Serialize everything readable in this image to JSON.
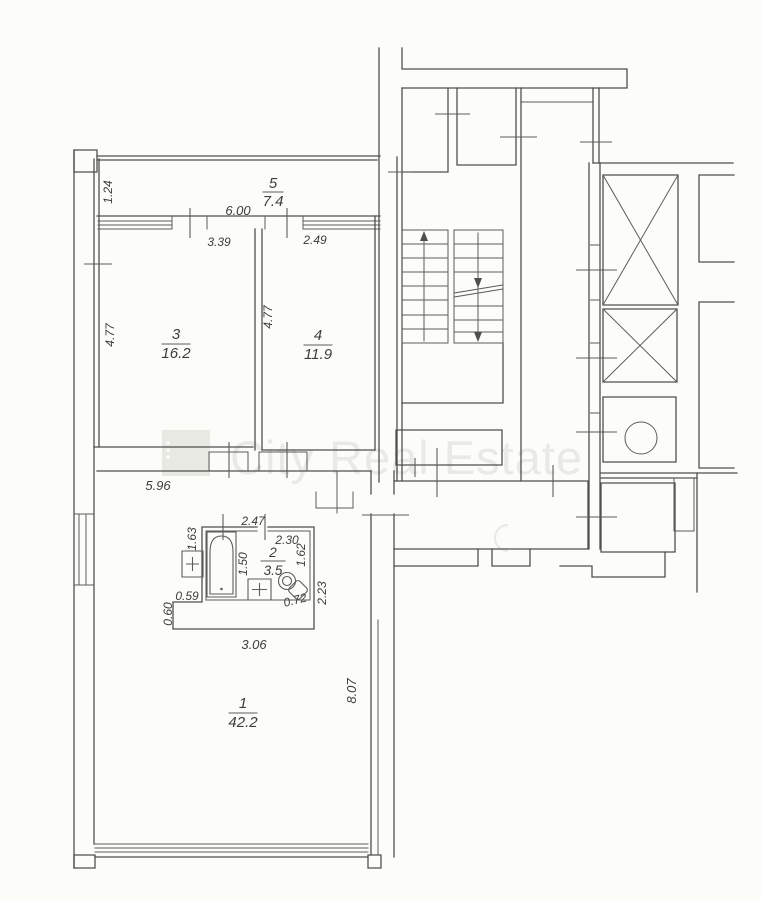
{
  "document_type": "apartment-floor-plan-scan",
  "watermark": {
    "text": "City Real Estate"
  },
  "rooms": {
    "r1": {
      "number": "1",
      "area": "42.2"
    },
    "r2": {
      "number": "2",
      "area": "3.5"
    },
    "r3": {
      "number": "3",
      "area": "16.2"
    },
    "r4": {
      "number": "4",
      "area": "11.9"
    },
    "r5": {
      "number": "5",
      "area": "7.4"
    }
  },
  "dims": {
    "d124": "1.24",
    "d600": "6.00",
    "d339": "3.39",
    "d249": "2.49",
    "d477a": "4.77",
    "d477b": "4.77",
    "d596": "5.96",
    "d247": "2.47",
    "d230": "2.30",
    "d163": "1.63",
    "d150": "1.50",
    "d162": "1.62",
    "d059": "0.59",
    "d060": "0.60",
    "d306": "3.06",
    "d072": "0.72",
    "d223": "2.23",
    "d807": "8.07"
  },
  "colors": {
    "wall_line": "#4f4f4f",
    "text": "#3d3d3d",
    "watermark": "#8a8a85",
    "background": "#fcfcf9"
  }
}
